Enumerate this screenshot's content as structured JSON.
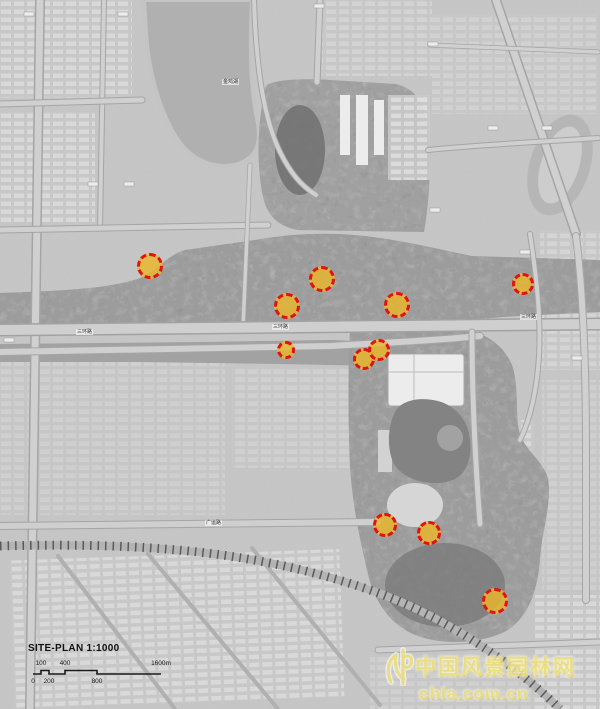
{
  "map": {
    "title": "SITE-PLAN 1:1000",
    "scale_bar": {
      "top_labels": [
        "100",
        "400",
        "1600m"
      ],
      "bottom_labels": [
        "0",
        "200",
        "800"
      ]
    },
    "road_labels": [
      {
        "text": "金鸡湖",
        "x": 222,
        "y": 79
      },
      {
        "text": "三环路",
        "x": 76,
        "y": 329
      },
      {
        "text": "三环路",
        "x": 272,
        "y": 324
      },
      {
        "text": "三环路",
        "x": 520,
        "y": 314
      },
      {
        "text": "广运路",
        "x": 205,
        "y": 520
      }
    ],
    "markers": [
      {
        "x": 150,
        "y": 266,
        "r": 13
      },
      {
        "x": 322,
        "y": 279,
        "r": 13
      },
      {
        "x": 287,
        "y": 306,
        "r": 13
      },
      {
        "x": 397,
        "y": 305,
        "r": 13
      },
      {
        "x": 523,
        "y": 284,
        "r": 11
      },
      {
        "x": 286,
        "y": 350,
        "r": 9
      },
      {
        "x": 364,
        "y": 359,
        "r": 11
      },
      {
        "x": 379,
        "y": 350,
        "r": 11
      },
      {
        "x": 385,
        "y": 525,
        "r": 12
      },
      {
        "x": 429,
        "y": 533,
        "r": 12
      },
      {
        "x": 495,
        "y": 601,
        "r": 13
      }
    ],
    "marker_style": {
      "fill": "#e9b62c",
      "border": "#e01212"
    }
  },
  "watermark": {
    "site_name": "中国风景园林网",
    "url": "chla.com.cn",
    "color": "#efe178"
  }
}
